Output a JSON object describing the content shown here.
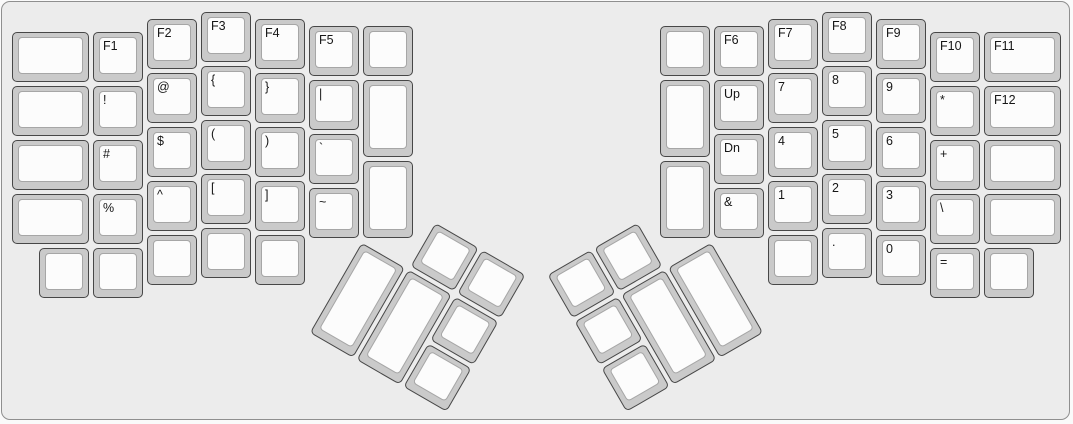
{
  "title": "ergodox-split-keyboard-layout",
  "unit_px": 54,
  "origin": {
    "x": 10,
    "y": 10
  },
  "colors": {
    "canvas_bg": "#ececec",
    "canvas_border": "#8f8f8f",
    "keycap_body": "#cacaca",
    "keycap_border": "#474747",
    "keycap_top": "#fcfcfc",
    "keycap_top_border": "#a6a6a6",
    "legend": "#161616"
  },
  "halves": {
    "left": {
      "keys": [
        {
          "x": 0,
          "y": 0.375,
          "w": 1.5,
          "l": "",
          "n": "blank"
        },
        {
          "x": 0,
          "y": 1.375,
          "w": 1.5,
          "l": "",
          "n": "blank"
        },
        {
          "x": 0,
          "y": 2.375,
          "w": 1.5,
          "l": "",
          "n": "blank"
        },
        {
          "x": 0,
          "y": 3.375,
          "w": 1.5,
          "l": "",
          "n": "blank"
        },
        {
          "x": 0.5,
          "y": 4.375,
          "l": "",
          "n": "blank"
        },
        {
          "x": 1.5,
          "y": 0.375,
          "l": "F1",
          "n": "f1"
        },
        {
          "x": 1.5,
          "y": 1.375,
          "l": "!",
          "n": "exclamation"
        },
        {
          "x": 1.5,
          "y": 2.375,
          "l": "#",
          "n": "hash"
        },
        {
          "x": 1.5,
          "y": 3.375,
          "l": "%",
          "n": "percent"
        },
        {
          "x": 1.5,
          "y": 4.375,
          "l": "",
          "n": "blank"
        },
        {
          "x": 2.5,
          "y": 0.125,
          "l": "F2",
          "n": "f2"
        },
        {
          "x": 2.5,
          "y": 1.125,
          "l": "@",
          "n": "at"
        },
        {
          "x": 2.5,
          "y": 2.125,
          "l": "$",
          "n": "dollar"
        },
        {
          "x": 2.5,
          "y": 3.125,
          "l": "^",
          "n": "caret"
        },
        {
          "x": 2.5,
          "y": 4.125,
          "l": "",
          "n": "blank"
        },
        {
          "x": 3.5,
          "y": 0,
          "l": "F3",
          "n": "f3"
        },
        {
          "x": 3.5,
          "y": 1,
          "l": "{",
          "n": "left-brace"
        },
        {
          "x": 3.5,
          "y": 2,
          "l": "(",
          "n": "left-paren"
        },
        {
          "x": 3.5,
          "y": 3,
          "l": "[",
          "n": "left-bracket"
        },
        {
          "x": 3.5,
          "y": 4,
          "l": "",
          "n": "blank"
        },
        {
          "x": 4.5,
          "y": 0.125,
          "l": "F4",
          "n": "f4"
        },
        {
          "x": 4.5,
          "y": 1.125,
          "l": "}",
          "n": "right-brace"
        },
        {
          "x": 4.5,
          "y": 2.125,
          "l": ")",
          "n": "right-paren"
        },
        {
          "x": 4.5,
          "y": 3.125,
          "l": "]",
          "n": "right-bracket"
        },
        {
          "x": 4.5,
          "y": 4.125,
          "l": "",
          "n": "blank"
        },
        {
          "x": 5.5,
          "y": 0.25,
          "l": "F5",
          "n": "f5"
        },
        {
          "x": 5.5,
          "y": 1.25,
          "l": "|",
          "n": "pipe"
        },
        {
          "x": 5.5,
          "y": 2.25,
          "l": "`",
          "n": "backtick"
        },
        {
          "x": 5.5,
          "y": 3.25,
          "l": "~",
          "n": "tilde"
        },
        {
          "x": 6.5,
          "y": 0.25,
          "l": "",
          "n": "blank"
        },
        {
          "x": 6.5,
          "y": 1.25,
          "h": 1.5,
          "l": "",
          "n": "blank"
        },
        {
          "x": 6.5,
          "y": 2.75,
          "h": 1.5,
          "l": "",
          "n": "blank"
        }
      ],
      "thumb": {
        "rotation": 30,
        "rx": 6.5,
        "ry": 4.25,
        "keys": [
          {
            "x": 1,
            "y": -1,
            "l": "",
            "n": "blank"
          },
          {
            "x": 2,
            "y": -1,
            "l": "",
            "n": "blank"
          },
          {
            "x": 0,
            "y": 0,
            "h": 2,
            "l": "",
            "n": "blank"
          },
          {
            "x": 1,
            "y": 0,
            "h": 2,
            "l": "",
            "n": "blank"
          },
          {
            "x": 2,
            "y": 0,
            "l": "",
            "n": "blank"
          },
          {
            "x": 2,
            "y": 1,
            "l": "",
            "n": "blank"
          }
        ]
      }
    },
    "right": {
      "keys": [
        {
          "x": 12,
          "y": 0.25,
          "l": "",
          "n": "blank"
        },
        {
          "x": 12,
          "y": 1.25,
          "h": 1.5,
          "l": "",
          "n": "blank"
        },
        {
          "x": 12,
          "y": 2.75,
          "h": 1.5,
          "l": "",
          "n": "blank"
        },
        {
          "x": 13,
          "y": 0.25,
          "l": "F6",
          "n": "f6"
        },
        {
          "x": 13,
          "y": 1.25,
          "l": "Up",
          "n": "up"
        },
        {
          "x": 13,
          "y": 2.25,
          "l": "Dn",
          "n": "down"
        },
        {
          "x": 13,
          "y": 3.25,
          "l": "&",
          "n": "ampersand"
        },
        {
          "x": 14,
          "y": 0.125,
          "l": "F7",
          "n": "f7"
        },
        {
          "x": 14,
          "y": 1.125,
          "l": "7",
          "n": "7"
        },
        {
          "x": 14,
          "y": 2.125,
          "l": "4",
          "n": "4"
        },
        {
          "x": 14,
          "y": 3.125,
          "l": "1",
          "n": "1"
        },
        {
          "x": 14,
          "y": 4.125,
          "l": "",
          "n": "blank"
        },
        {
          "x": 15,
          "y": 0,
          "l": "F8",
          "n": "f8"
        },
        {
          "x": 15,
          "y": 1,
          "l": "8",
          "n": "8"
        },
        {
          "x": 15,
          "y": 2,
          "l": "5",
          "n": "5"
        },
        {
          "x": 15,
          "y": 3,
          "l": "2",
          "n": "2"
        },
        {
          "x": 15,
          "y": 4,
          "l": ".",
          "n": "period"
        },
        {
          "x": 16,
          "y": 0.125,
          "l": "F9",
          "n": "f9"
        },
        {
          "x": 16,
          "y": 1.125,
          "l": "9",
          "n": "9"
        },
        {
          "x": 16,
          "y": 2.125,
          "l": "6",
          "n": "6"
        },
        {
          "x": 16,
          "y": 3.125,
          "l": "3",
          "n": "3"
        },
        {
          "x": 16,
          "y": 4.125,
          "l": "0",
          "n": "0"
        },
        {
          "x": 17,
          "y": 0.375,
          "l": "F10",
          "n": "f10"
        },
        {
          "x": 17,
          "y": 1.375,
          "l": "*",
          "n": "asterisk"
        },
        {
          "x": 17,
          "y": 2.375,
          "l": "+",
          "n": "plus"
        },
        {
          "x": 17,
          "y": 3.375,
          "l": "\\",
          "n": "backslash"
        },
        {
          "x": 17,
          "y": 4.375,
          "l": "=",
          "n": "equals"
        },
        {
          "x": 18,
          "y": 0.375,
          "w": 1.5,
          "l": "F11",
          "n": "f11"
        },
        {
          "x": 18,
          "y": 1.375,
          "w": 1.5,
          "l": "F12",
          "n": "f12"
        },
        {
          "x": 18,
          "y": 2.375,
          "w": 1.5,
          "l": "",
          "n": "blank"
        },
        {
          "x": 18,
          "y": 3.375,
          "w": 1.5,
          "l": "",
          "n": "blank"
        },
        {
          "x": 18,
          "y": 4.375,
          "l": "",
          "n": "blank"
        }
      ],
      "thumb": {
        "rotation": -30,
        "rx": 13,
        "ry": 4.25,
        "keys": [
          {
            "x": -3,
            "y": -1,
            "l": "",
            "n": "blank"
          },
          {
            "x": -2,
            "y": -1,
            "l": "",
            "n": "blank"
          },
          {
            "x": -3,
            "y": 0,
            "l": "",
            "n": "blank"
          },
          {
            "x": -3,
            "y": 1,
            "l": "",
            "n": "blank"
          },
          {
            "x": -2,
            "y": 0,
            "h": 2,
            "l": "",
            "n": "blank"
          },
          {
            "x": -1,
            "y": 0,
            "h": 2,
            "l": "",
            "n": "blank"
          }
        ]
      }
    }
  }
}
